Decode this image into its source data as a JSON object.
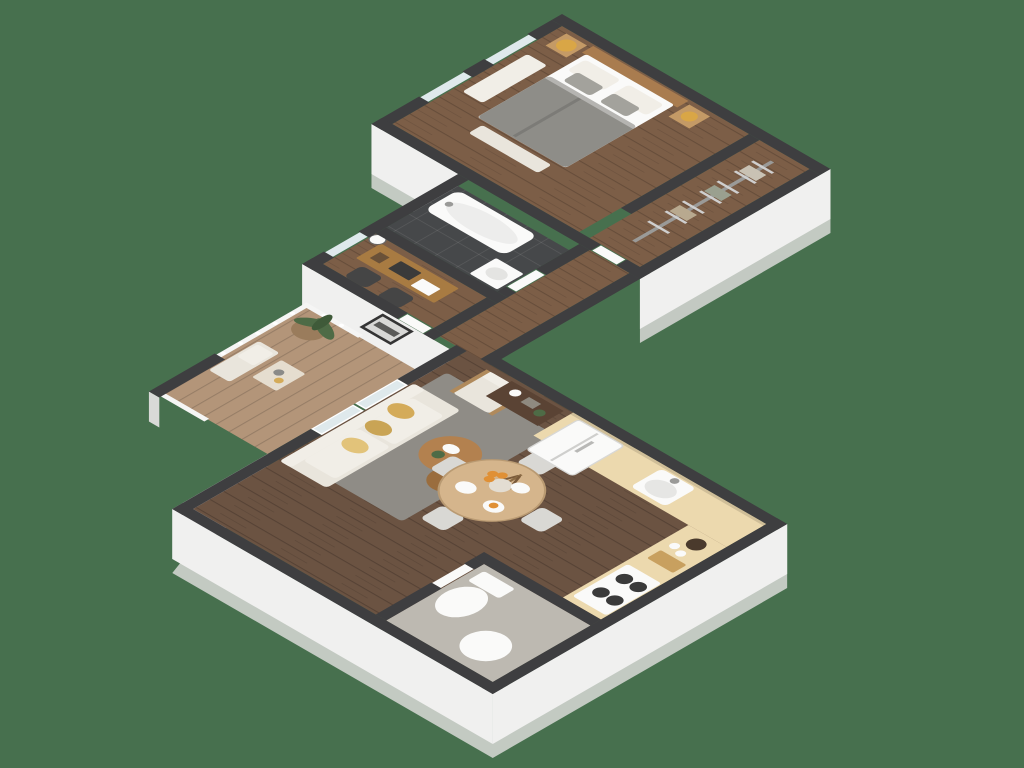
{
  "scene": {
    "type": "isometric-3d-apartment-floor-plan",
    "view": "top-down isometric cutaway, no visible text",
    "background_color": "#47704e",
    "rooms": [
      {
        "id": "bedroom",
        "label": "Bedroom",
        "floor": "mid-brown wood plank",
        "furniture": [
          "double-bed",
          "gray-duvet",
          "white-pillows",
          "wood-headboard",
          "nightstand-left",
          "nightstand-right",
          "table-lamps",
          "wall-art-frames",
          "foot-bench",
          "runner-rug",
          "windows"
        ]
      },
      {
        "id": "closet",
        "label": "Walk-in closet",
        "floor": "mid-brown wood plank",
        "furniture": [
          "hanging-rail",
          "clothes-hangers",
          "hung-clothes"
        ]
      },
      {
        "id": "bathroom",
        "label": "Bathroom",
        "floor": "dark gray tile",
        "furniture": [
          "bathtub",
          "faucet",
          "vanity-sink",
          "door"
        ]
      },
      {
        "id": "office",
        "label": "Home office",
        "floor": "mid-brown wood plank",
        "furniture": [
          "desk",
          "laptop",
          "documents",
          "office-chair",
          "office-chair-2",
          "wall-clock",
          "window",
          "door"
        ]
      },
      {
        "id": "hallway",
        "label": "Hallway",
        "floor": "mid-brown wood plank",
        "furniture": [
          "framed-artwork",
          "entry-door"
        ]
      },
      {
        "id": "living-dining",
        "label": "Living / dining room",
        "floor": "dark herringbone wood",
        "furniture": [
          "sofa",
          "yellow-throw-pillows",
          "area-rug",
          "armchair",
          "nesting-coffee-tables",
          "round-dining-table",
          "dining-chairs-x4",
          "vase-with-dried-stems",
          "plates",
          "oranges",
          "sliding-glass-door"
        ]
      },
      {
        "id": "kitchen",
        "label": "Kitchen",
        "floor": "dark herringbone wood",
        "furniture": [
          "refrigerator",
          "counter-l-shaped",
          "sink",
          "faucet",
          "cooktop-stove",
          "coffee-station",
          "console-table"
        ]
      },
      {
        "id": "wc",
        "label": "WC",
        "floor": "light gray tile",
        "furniture": [
          "toilet",
          "round-laundry-basket",
          "door"
        ]
      },
      {
        "id": "balcony",
        "label": "Balcony",
        "floor": "light washed deck boards",
        "furniture": [
          "white-railing",
          "potted-plant",
          "bench-seat",
          "side-table",
          "privacy-wall-stub"
        ]
      }
    ],
    "palette": {
      "bg": "#47704e",
      "wall": "#3e3e40",
      "face": "#f0f0ef",
      "faceShade": "#d9d9d7",
      "woodMid": "#7c5e47",
      "woodDark": "#6b5342",
      "deck": "#b39579",
      "tileDark": "#46484a",
      "wcFloor": "#bdb9b1",
      "counter": "#ecd9ae",
      "white": "#fafaf9",
      "cream": "#e9e5dc",
      "creamLight": "#f1eee7",
      "rug": "#8f8c86",
      "pillow": "#d4ab59",
      "tableWood": "#d5b58c",
      "deskWood": "#a87b42",
      "headboard": "#a97c4f",
      "duvet": "#8e8d88",
      "pillowGray": "#a3a29c",
      "glass": "#dfe9ec",
      "rail": "#f5f5f4",
      "console": "#5a4334",
      "plant": "#4e6b46",
      "pot": "#9a7c5c",
      "lamp": "#d9a646",
      "art": "#343434",
      "chair": "#d9d8d4",
      "officeChair": "#454545",
      "orange": "#e09035",
      "nightstand": "#c49a66",
      "coffeeTable": "#b3814f",
      "coffeeTableSm": "#9a6d3e",
      "steel": "#9a9a98"
    }
  }
}
